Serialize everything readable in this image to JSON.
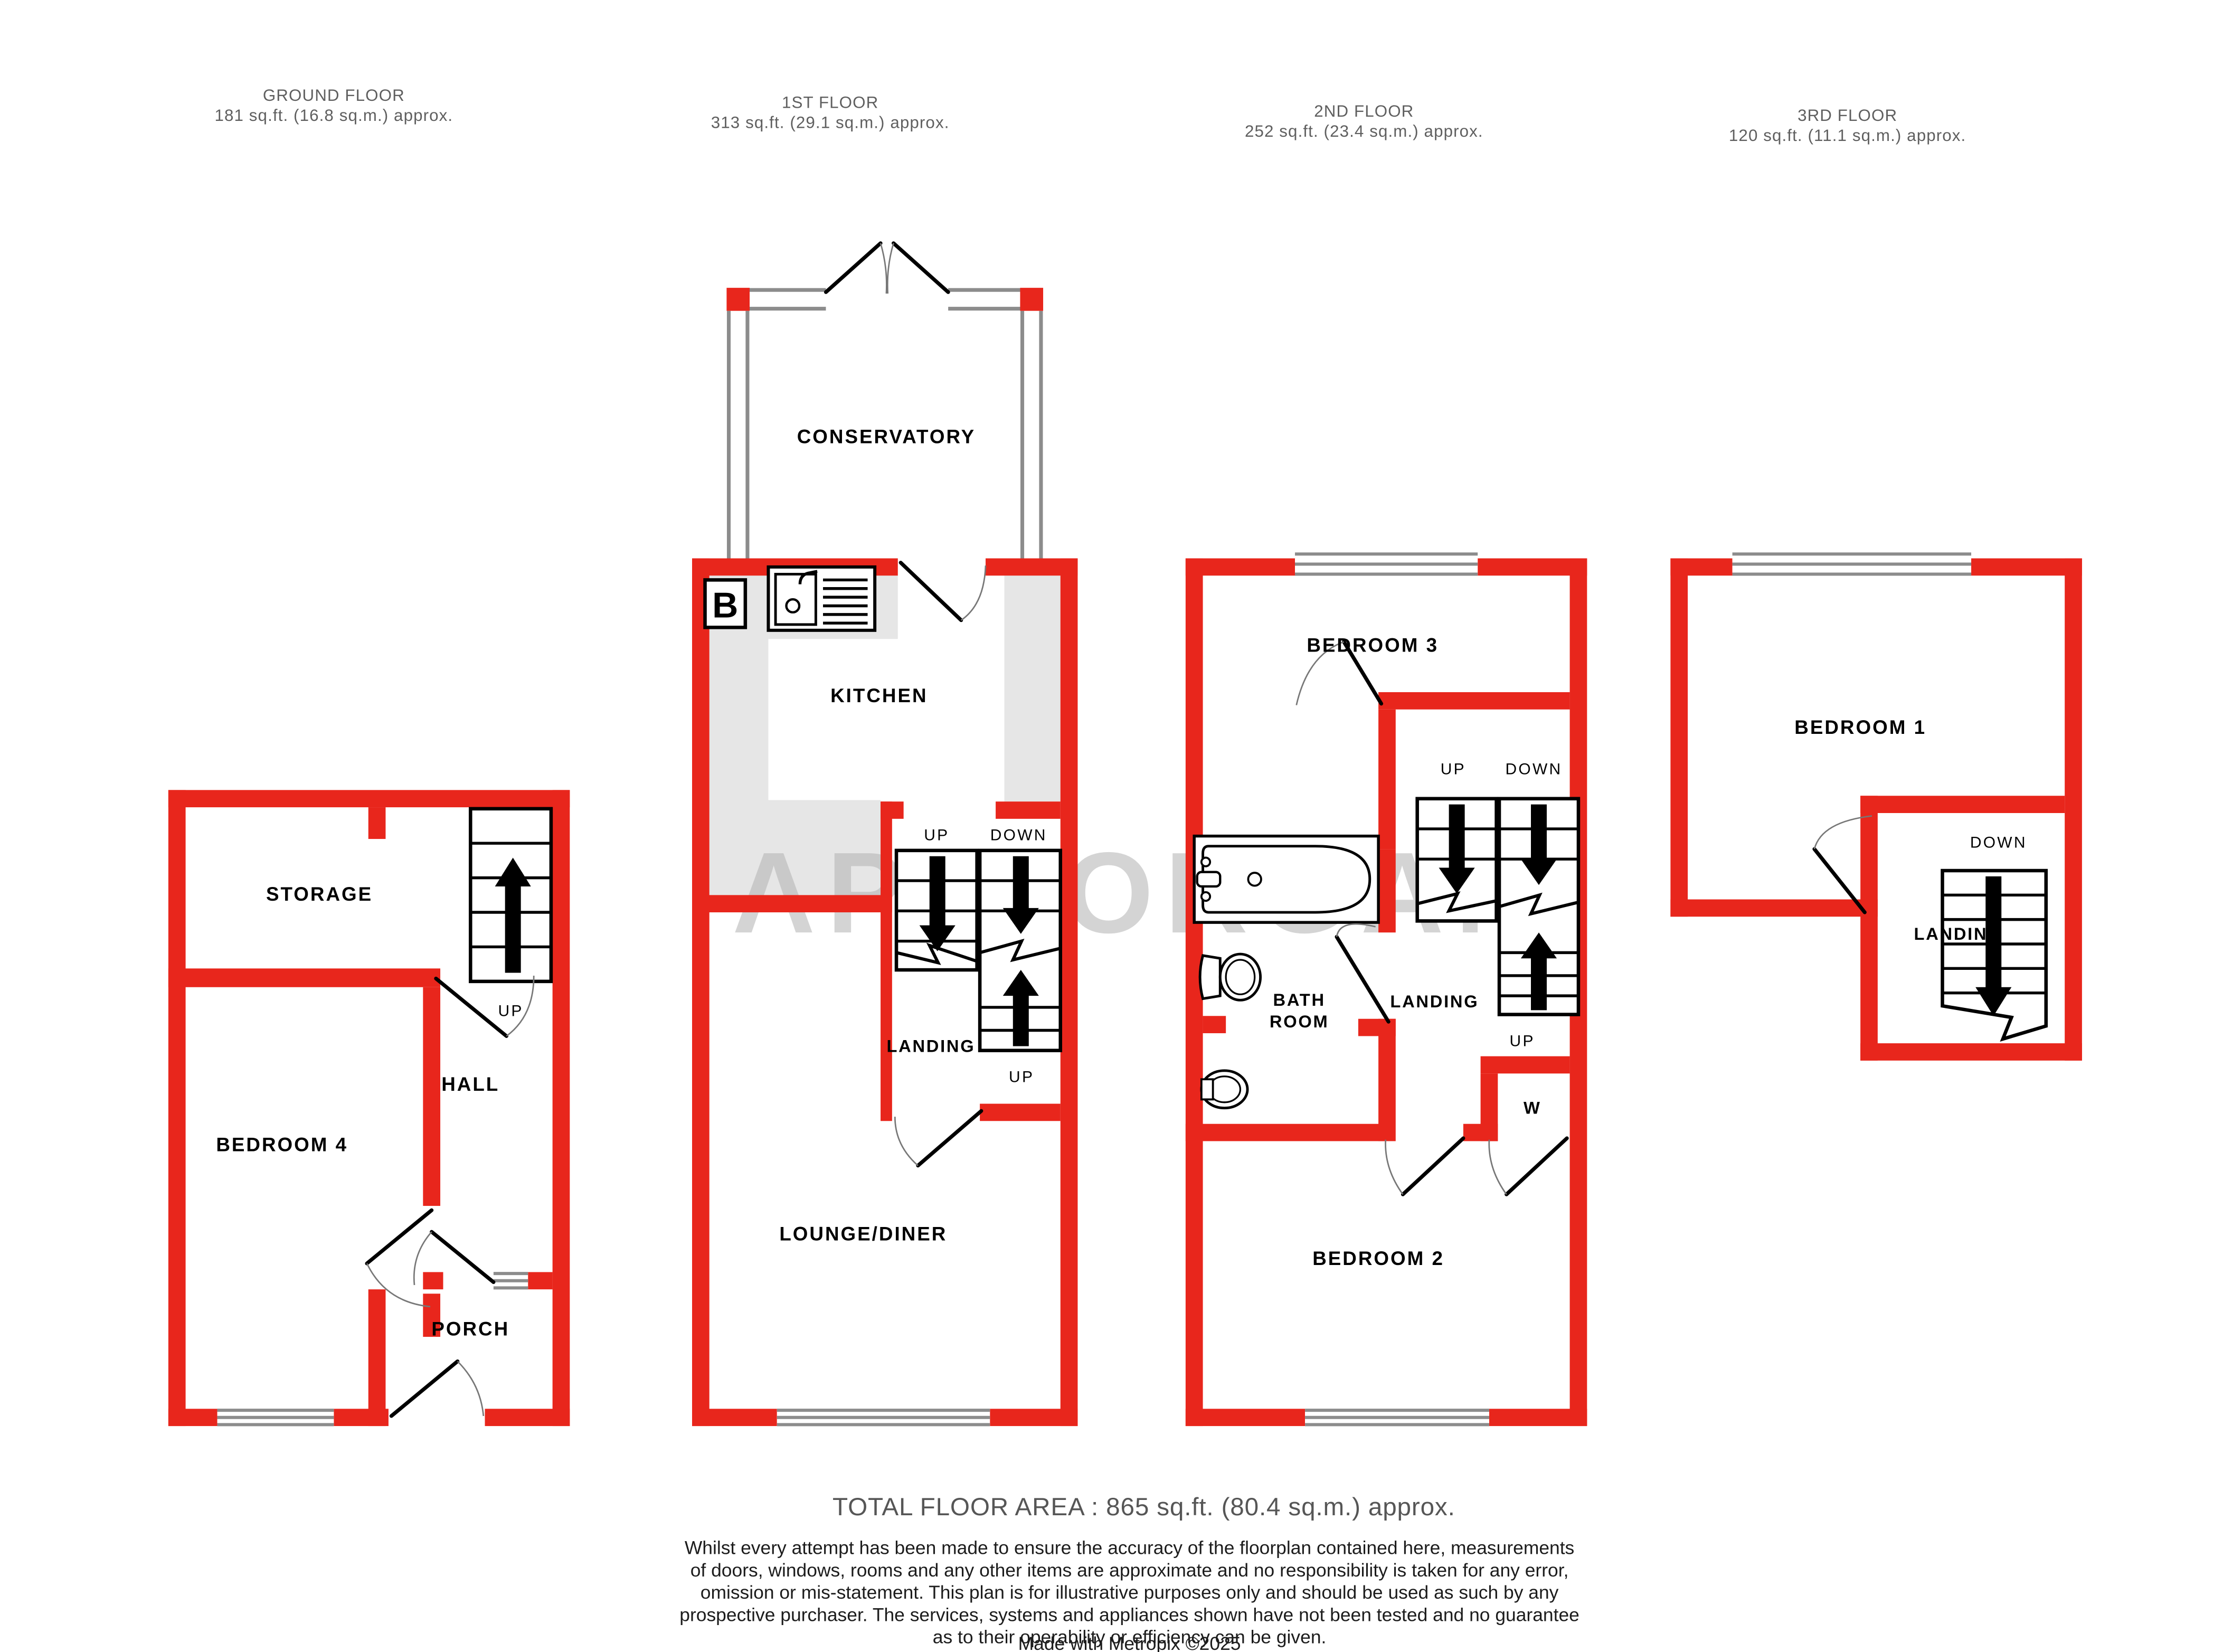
{
  "colors": {
    "wall_red": "#e8261c",
    "window_gray": "#8c8c8c",
    "floor_gray": "#e6e6e6",
    "watermark_gray": "#b2b2b2",
    "label_black": "#000000",
    "header_gray": "#5f5f5f"
  },
  "watermark": "AP MORGAN",
  "floors": [
    {
      "title": "GROUND FLOOR",
      "area": "181 sq.ft. (16.8 sq.m.) approx."
    },
    {
      "title": "1ST FLOOR",
      "area": "313 sq.ft. (29.1 sq.m.) approx."
    },
    {
      "title": "2ND FLOOR",
      "area": "252 sq.ft. (23.4 sq.m.) approx."
    },
    {
      "title": "3RD FLOOR",
      "area": "120 sq.ft. (11.1 sq.m.) approx."
    }
  ],
  "rooms": {
    "storage": "STORAGE",
    "hall": "HALL",
    "bedroom4": "BEDROOM 4",
    "porch": "PORCH",
    "conservatory": "CONSERVATORY",
    "kitchen": "KITCHEN",
    "landing1": "LANDING",
    "lounge_diner": "LOUNGE/DINER",
    "bedroom3": "BEDROOM 3",
    "bath_line1": "BATH",
    "bath_line2": "ROOM",
    "landing2": "LANDING",
    "wardrobe": "W",
    "bedroom2": "BEDROOM 2",
    "bedroom1": "BEDROOM 1",
    "landing3": "LANDING"
  },
  "stairs": {
    "up": "UP",
    "down": "DOWN"
  },
  "boiler": "B",
  "footer": {
    "total": "TOTAL FLOOR AREA : 865 sq.ft. (80.4 sq.m.) approx.",
    "disclaimer": [
      "Whilst every attempt has been made to ensure the accuracy of the floorplan contained here, measurements",
      "of doors, windows, rooms and any other items are approximate and no responsibility is taken for any error,",
      "omission or mis-statement. This plan is for illustrative purposes only and should be used as such by any",
      "prospective purchaser. The services, systems and appliances shown have not been tested and no guarantee",
      "as to their operability or efficiency can be given."
    ],
    "credit": "Made with Metropix ©2025"
  }
}
